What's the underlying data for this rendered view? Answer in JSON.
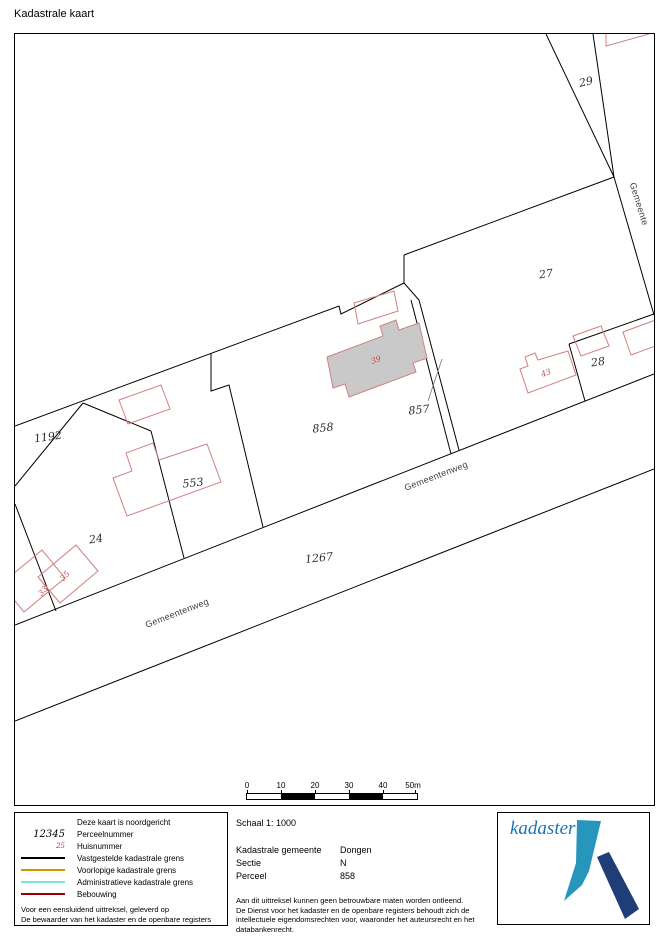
{
  "page": {
    "title": "Kadastrale kaart"
  },
  "map": {
    "parcel_labels": {
      "p29": "29",
      "p27": "27",
      "p28": "28",
      "p858": "858",
      "p857": "857",
      "p553": "553",
      "p1192": "1192",
      "p24": "24",
      "p1267": "1267"
    },
    "house_numbers": {
      "h39": "39",
      "h43": "43",
      "h35": "35",
      "h33": "33"
    },
    "road_labels": {
      "road1": "Gemeentenweg",
      "road2": "Gemeentenweg",
      "road3": "Gemeente"
    },
    "scale_bar": {
      "ticks": [
        "0",
        "10",
        "20",
        "30",
        "40",
        "50m"
      ]
    }
  },
  "legend": {
    "north_note": "Deze kaart is noordgericht",
    "items": [
      {
        "sample": "12345",
        "label": "Perceelnummer"
      },
      {
        "sample": "25",
        "label": "Huisnummer"
      },
      {
        "label": "Vastgestelde kadastrale grens",
        "color": "#000000"
      },
      {
        "label": "Voorlopige kadastrale grens",
        "color": "#cc9900"
      },
      {
        "label": "Administratieve kadastrale grens",
        "color": "#7fe3d4"
      },
      {
        "label": "Bebouwing",
        "color": "#990000"
      }
    ],
    "footer_lines": [
      "Voor een eensluidend uittreksel, geleverd op",
      "De bewaarder van het kadaster en de openbare registers"
    ]
  },
  "details": {
    "scale_label": "Schaal 1: 1000",
    "rows": [
      {
        "label": "Kadastrale gemeente",
        "value": "Dongen"
      },
      {
        "label": "Sectie",
        "value": "N"
      },
      {
        "label": "Perceel",
        "value": "858"
      }
    ],
    "disclaimer": [
      "Aan dit uittreksel kunnen geen betrouwbare maten worden ontleend.",
      "De Dienst voor het kadaster en de openbare registers behoudt zich de intellectuele eigendomsrechten voor, waaronder het auteursrecht en het databankenrecht."
    ]
  },
  "logo": {
    "wordmark": "kadaster"
  },
  "colors": {
    "boundary": "#000000",
    "building_outline": "#d08080",
    "building_fill": "#c9c9c9",
    "house_number": "#c05050",
    "provisional_grens": "#cc9900",
    "administrative_grens": "#7fe3d4",
    "bebouwing": "#990000",
    "logo_light_blue": "#2696bd",
    "logo_dark_blue": "#1f3e78",
    "logo_text_blue": "#1e73b2"
  }
}
